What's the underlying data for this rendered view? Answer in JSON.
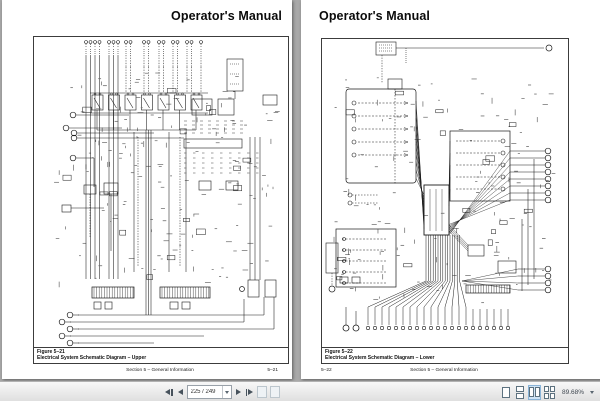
{
  "viewer": {
    "background_color": "#a9a9a9",
    "toolbar": {
      "page_field_value": "225 / 249",
      "zoom_level": "89.68%",
      "selected_view": "facing-view",
      "accent_color": "#8ab4d8",
      "icons": [
        {
          "name": "first-page-icon",
          "glyph": "◀|"
        },
        {
          "name": "prev-page-icon",
          "glyph": "◀"
        },
        {
          "name": "page-field-caret-icon",
          "glyph": "▾"
        },
        {
          "name": "next-page-icon",
          "glyph": "▶"
        },
        {
          "name": "last-page-icon",
          "glyph": "|▶"
        },
        {
          "name": "prev-view-icon",
          "glyph": "▭"
        },
        {
          "name": "next-view-icon",
          "glyph": "▭"
        },
        {
          "name": "single-page-view-icon",
          "glyph": "▯"
        },
        {
          "name": "continuous-view-icon",
          "glyph": "▯"
        },
        {
          "name": "facing-view-icon",
          "glyph": "▯▯"
        },
        {
          "name": "continuous-facing-view-icon",
          "glyph": "▯▯"
        },
        {
          "name": "zoom-caret-icon",
          "glyph": "▾"
        },
        {
          "name": "zoom-out-icon",
          "glyph": "⊖"
        },
        {
          "name": "zoom-slider",
          "glyph": "—"
        }
      ]
    }
  },
  "pages": {
    "left": {
      "header": "Operator's Manual",
      "figure_label": "Figure 5–21",
      "figure_title": "Electrical System Schematic Diagram – Upper",
      "footer_section": "Section 5 – General Information",
      "footer_page": "5–21"
    },
    "right": {
      "header": "Operator's Manual",
      "figure_label": "Figure 5–22",
      "figure_title": "Electrical System Schematic Diagram – Lower",
      "footer_section": "Section 5 – General Information",
      "footer_page": "5–22"
    }
  }
}
